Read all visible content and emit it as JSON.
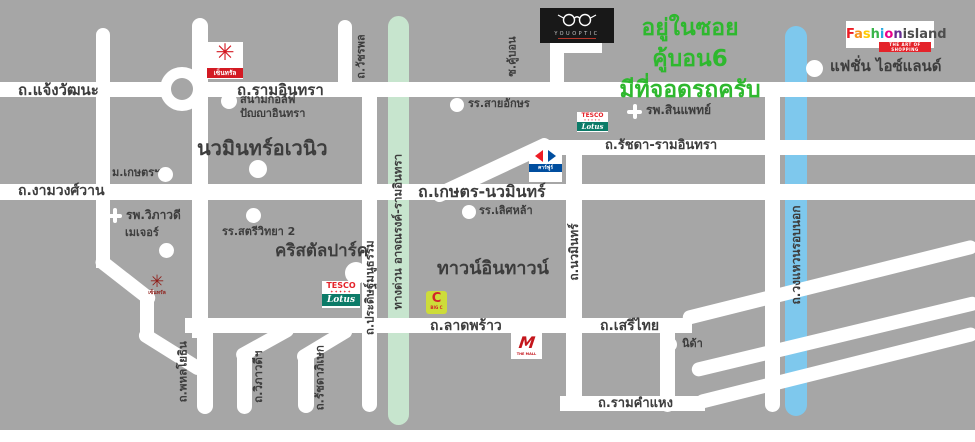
{
  "map": {
    "promo": {
      "line1": "อยู่ในซอย คู้บอน6",
      "line2": "มีที่จอดรถครับ"
    },
    "colors": {
      "background": "#a6a6a6",
      "road": "#ffffff",
      "expressway_green": "#c7e5ce",
      "ring_road_blue": "#7ec8ed",
      "label": "#3d3d3d",
      "promo_green": "#2eb82e"
    },
    "road_labels": [
      {
        "id": "chaengwattana",
        "label": "ถ.แจ้งวัฒนะ"
      },
      {
        "id": "ramindra",
        "label": "ถ.รามอินทรา"
      },
      {
        "id": "watcharaphon",
        "label": "ถ.วัชรพล"
      },
      {
        "id": "soi-kubon",
        "label": "ซ.คู้บอน"
      },
      {
        "id": "ngamwongwan",
        "label": "ถ.งามวงศ์วาน"
      },
      {
        "id": "kaset-nawamin",
        "label": "ถ.เกษตร-นวมินทร์"
      },
      {
        "id": "ratchada-ramindra",
        "label": "ถ.รัชดา-รามอินทรา"
      },
      {
        "id": "pradit-manutham",
        "label": "ถ.ประดิษฐ์มนูธรรม"
      },
      {
        "id": "expressway",
        "label": "ทางด่วน อาจณรงค์-รามอินทรา"
      },
      {
        "id": "outer-ring-road",
        "label": "ถ.วงแหวนรอบนอก"
      },
      {
        "id": "nawamin",
        "label": "ถ.นวมินทร์"
      },
      {
        "id": "ladprao",
        "label": "ถ.ลาดพร้าว"
      },
      {
        "id": "serithai",
        "label": "ถ.เสรีไทย"
      },
      {
        "id": "ramkhamhaeng",
        "label": "ถ.รามคำแหง"
      },
      {
        "id": "phahonyothin",
        "label": "ถ.พหลโยธิน"
      },
      {
        "id": "viphavadi",
        "label": "ถ.วิภาวดีฯ"
      },
      {
        "id": "ratchadaphisek",
        "label": "ถ.รัชดาภิเษก"
      }
    ],
    "landmarks": [
      {
        "id": "golf-course",
        "label": "สนามกอล์ฟ",
        "label2": "ปัญญาอินทรา"
      },
      {
        "id": "navamin-avenue",
        "label": "นวมินทร์อเวนิว"
      },
      {
        "id": "kasetsart-university",
        "label": "ม.เกษตรฯ"
      },
      {
        "id": "vibhavadi-hospital",
        "label": "รพ.วิภาวดี"
      },
      {
        "id": "major",
        "label": "เมเจอร์"
      },
      {
        "id": "satriwitthaya2-school",
        "label": "รร.สตรีวิทยา 2"
      },
      {
        "id": "crystal-park",
        "label": "คริสตัลปาร์ค"
      },
      {
        "id": "town-in-town",
        "label": "ทาวน์อินทาวน์"
      },
      {
        "id": "saiaksorn-school",
        "label": "รร.สายอักษร"
      },
      {
        "id": "lertlah-school",
        "label": "รร.เลิศหล้า"
      },
      {
        "id": "synphaet-hospital",
        "label": "รพ.สินแพทย์"
      },
      {
        "id": "fashion-island",
        "label": "แฟชั่น ไอซ์แลนด์"
      },
      {
        "id": "nida",
        "label": "นิด้า"
      }
    ],
    "logos": {
      "youoptic": {
        "name": "YOUOPTIC"
      },
      "fashion_island": {
        "letters": [
          {
            "ch": "F",
            "color": "#ed1c24"
          },
          {
            "ch": "a",
            "color": "#f7941d"
          },
          {
            "ch": "s",
            "color": "#ffcb05"
          },
          {
            "ch": "h",
            "color": "#39b54a"
          },
          {
            "ch": "i",
            "color": "#27aae1"
          },
          {
            "ch": "o",
            "color": "#ec008c"
          },
          {
            "ch": "n",
            "color": "#662d91"
          }
        ],
        "word2": "island",
        "tagline": "THE ART OF SHOPPING"
      },
      "central": {
        "label": "เซ็นทรัล",
        "burst": "✳"
      },
      "tesco_lotus": {
        "line1": "TESCO",
        "line2": "Lotus"
      },
      "carrefour": {
        "label": "คาร์ฟูร์"
      },
      "big_c": {
        "letter": "C",
        "sub": "BIG C"
      },
      "the_mall": {
        "letter": "M",
        "sub": "THE MALL"
      }
    }
  }
}
